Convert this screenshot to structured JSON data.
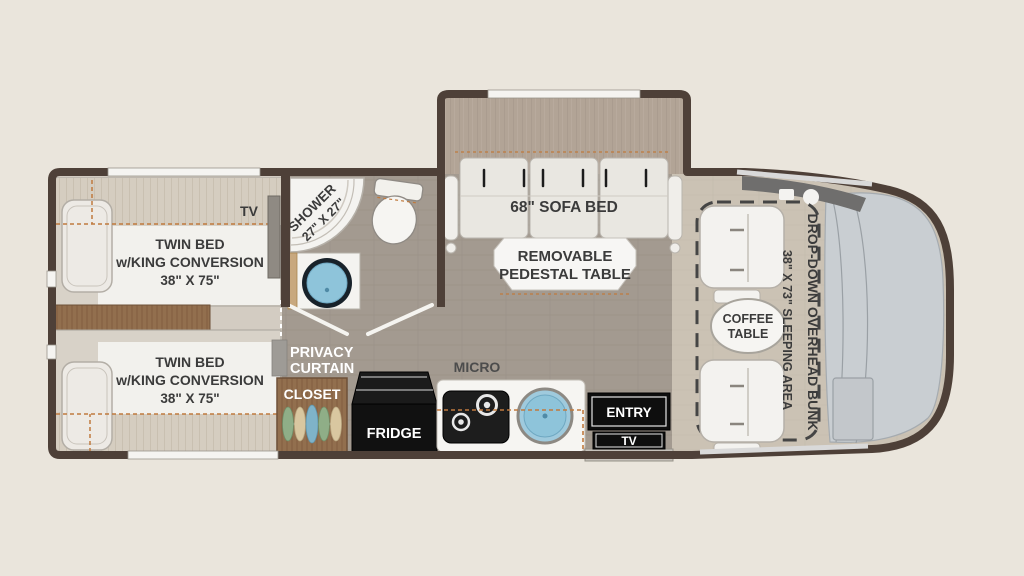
{
  "title": "RV Floor Plan",
  "colors": {
    "background": "#eae5dc",
    "wall": "#4e4038",
    "tile_floor": "#a39a90",
    "carpet": "#d3ccc2",
    "lounge_floor": "#cbc2b4",
    "wood": "#926f4e",
    "accent_dash_orange": "#c07a3e",
    "sink_blue": "#8ec4da",
    "appliance_black": "#111111",
    "windshield_gray": "#c9ced2"
  },
  "bedroom": {
    "tv_label": "TV",
    "bed_top": {
      "l1": "TWIN BED",
      "l2": "w/KING CONVERSION",
      "l3": "38\" X 75\""
    },
    "bed_bottom": {
      "l1": "TWIN BED",
      "l2": "w/KING CONVERSION",
      "l3": "38\" X 75\""
    }
  },
  "bathroom": {
    "shower_l1": "SHOWER",
    "shower_l2": "27\" X 27\"",
    "privacy_l1": "PRIVACY",
    "privacy_l2": "CURTAIN"
  },
  "kitchen": {
    "closet": "CLOSET",
    "fridge": "FRIDGE",
    "micro": "MICRO"
  },
  "entry": {
    "entry": "ENTRY",
    "tv": "TV"
  },
  "living": {
    "sofa": "68\" SOFA BED",
    "table_l1": "REMOVABLE",
    "table_l2": "PEDESTAL TABLE",
    "coffee_l1": "COFFEE",
    "coffee_l2": "TABLE",
    "bunk_l1": "DROP-DOWN OVERHEAD BUNK",
    "bunk_l2": "38\" X 73\" SLEEPING AREA"
  }
}
